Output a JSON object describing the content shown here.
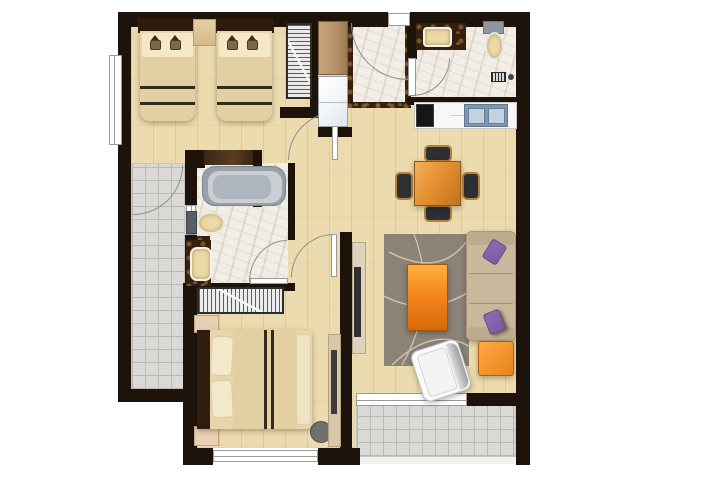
{
  "document": {
    "title": "Apartment floor plan (2-bedroom unit, top-down render)"
  },
  "colors": {
    "wall": "#1e130a",
    "wood": "#ecdbae",
    "tile": "#dbd9d5",
    "tileLine": "#bab8b4",
    "marble": "#f2eee6",
    "emperador": "#33200e",
    "tubOuter": "#99a0a8",
    "tubMid": "#c9ced4",
    "tubWell": "#aeb5bc",
    "cream": "#ecd9a4",
    "fixtureGray": "#8e959d",
    "counter": "#f7f7f7",
    "cooktop": "#161616",
    "sinkSteel": "#7f97ad",
    "sinkBasin": "#c2d2df",
    "tableA": "#f5b05c",
    "tableB": "#c0731a",
    "chairSeat": "#2e2e35",
    "chairFrame": "#b5803a",
    "rug": "#8b8376",
    "rugLine": "#cfc6b5",
    "coffeeA": "#ffb040",
    "coffeeB": "#d96a0a",
    "sofa": "#c9b99c",
    "sofaArm": "#bcab8c",
    "sofaSeam": "#a3926f",
    "purpleA": "#7b5ca3",
    "purpleB": "#8a6bb5",
    "ottomanA": "#ffaa45",
    "ottomanB": "#e8821a",
    "armchair": "#fbfbfb",
    "console": "#ddd3bb",
    "tvDark": "#2f2f2f",
    "headboard": "#2e1c0d",
    "mattress": "#e8d6a9",
    "pillow": "#f3e8ca",
    "blanket": "#e3d0a2",
    "stripe": "#33291c",
    "shelfTan": "#d6ba8e",
    "wardrobeBg": "#ebebeb",
    "wardrobeStripe": "#5c5c5c",
    "cabinet": "#b59169",
    "appliance": "#f3f6f8",
    "nightstand": "#e9cfb4",
    "desk": "#d9c8a8",
    "chairGray": "#707070",
    "windowFrame": "#9a9a9a",
    "arc": "#8f8f8f",
    "shelfDark": "#3a2715"
  },
  "legend": {
    "rooms": [
      "twin bedroom",
      "entry foyer",
      "bathroom 1",
      "kitchen",
      "dining area",
      "living room",
      "bathroom 2 with bathtub",
      "master bedroom",
      "side balcony",
      "rear balcony"
    ],
    "furniture": [
      "two single beds",
      "bedside shelf",
      "two wardrobes",
      "entry cabinet",
      "washing machine",
      "vanity sinks",
      "two toilets",
      "bathtub",
      "cooktop",
      "kitchen sink",
      "dining table with four chairs",
      "TV console",
      "area rug",
      "coffee table",
      "three-seat sofa with purple cushions",
      "orange ottoman",
      "white armchair",
      "double bed",
      "two nightstands",
      "desk with chair"
    ]
  }
}
